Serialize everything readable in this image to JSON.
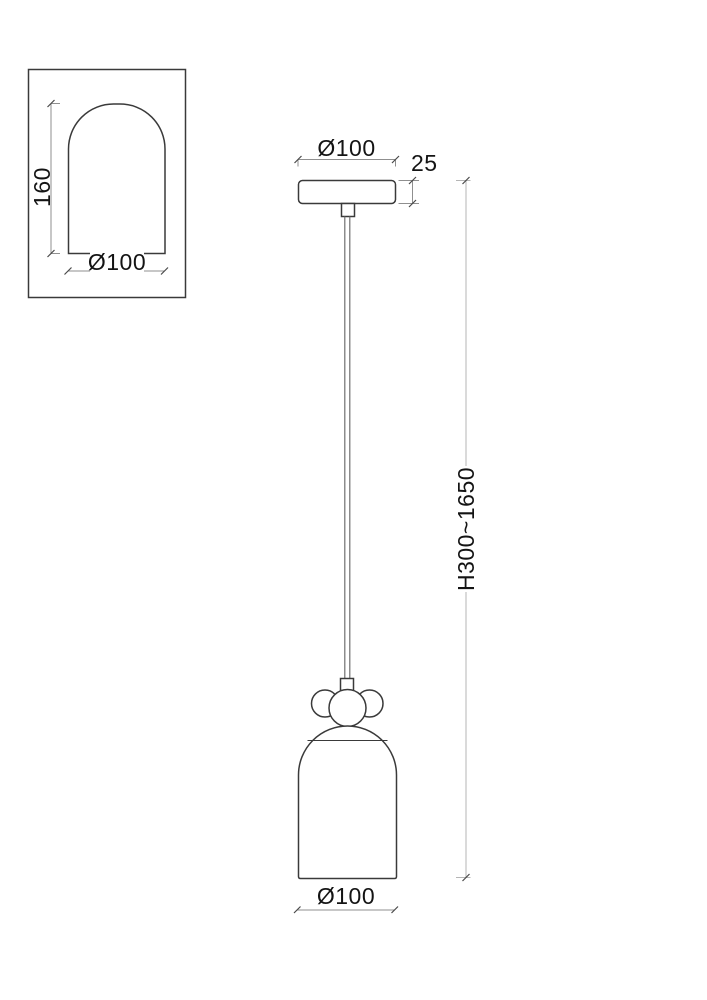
{
  "inset": {
    "height_label": "160",
    "diameter_label": "Ø100"
  },
  "pendant": {
    "canopy_diameter_label": "Ø100",
    "canopy_height_label": "25",
    "height_range_label": "H300~1650",
    "shade_diameter_label": "Ø100"
  },
  "colors": {
    "background": "#ffffff",
    "outline": "#3a3a3a",
    "dimension": "#8f8f8f",
    "light_line": "#b5b5b5",
    "tick": "#4a4a4a",
    "cord": "#6f6f6f",
    "text": "#141414"
  }
}
